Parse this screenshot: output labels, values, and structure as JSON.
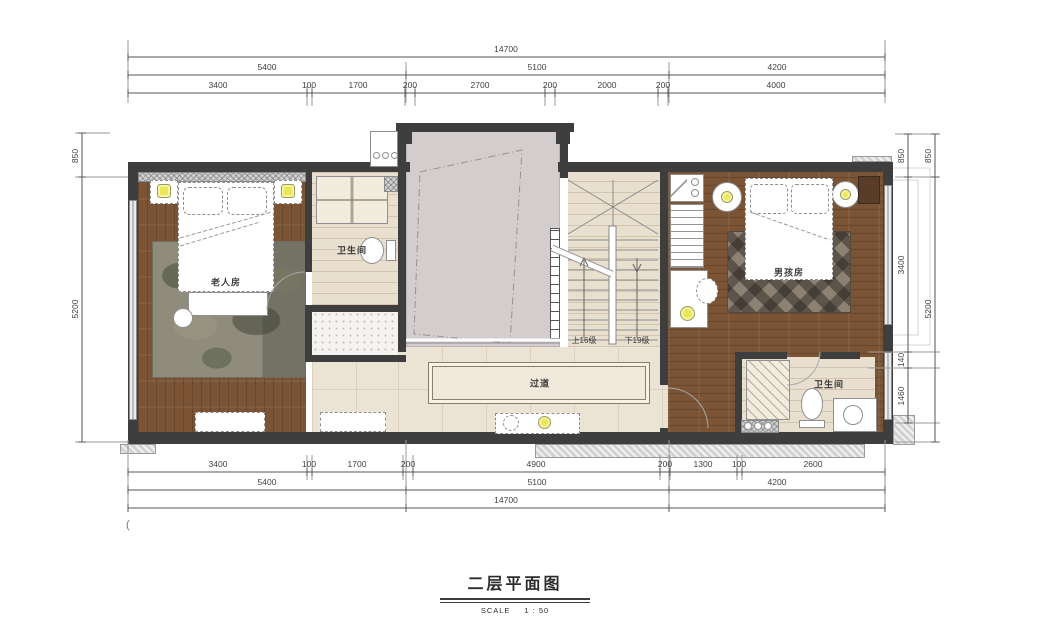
{
  "title": {
    "main": "二层平面图",
    "scale_label": "SCALE",
    "scale_value": "1 : 50"
  },
  "labels": {
    "elder_room": "老人房",
    "bath_left": "卫生间",
    "bath_right": "卫生间",
    "boy_room": "男孩房",
    "corridor": "过道",
    "stairs_up": "上16级",
    "stairs_down": "下19级",
    "stray_mark": "("
  },
  "dims": {
    "top_overall": "14700",
    "top_row2": [
      "5400",
      "5100",
      "4200"
    ],
    "top_row3": [
      "3400",
      "100",
      "1700",
      "200",
      "2700",
      "200",
      "2000",
      "200",
      "4000"
    ],
    "bottom_row1": [
      "3400",
      "100",
      "1700",
      "200",
      "4900",
      "200",
      "1300",
      "100",
      "2600"
    ],
    "bottom_row2": [
      "5400",
      "5100",
      "4200"
    ],
    "bottom_overall": "14700",
    "left": [
      "850",
      "5200"
    ],
    "right_inner": [
      "850",
      "3400",
      "140",
      "1460"
    ],
    "right_outer": [
      "850",
      "5200"
    ]
  }
}
